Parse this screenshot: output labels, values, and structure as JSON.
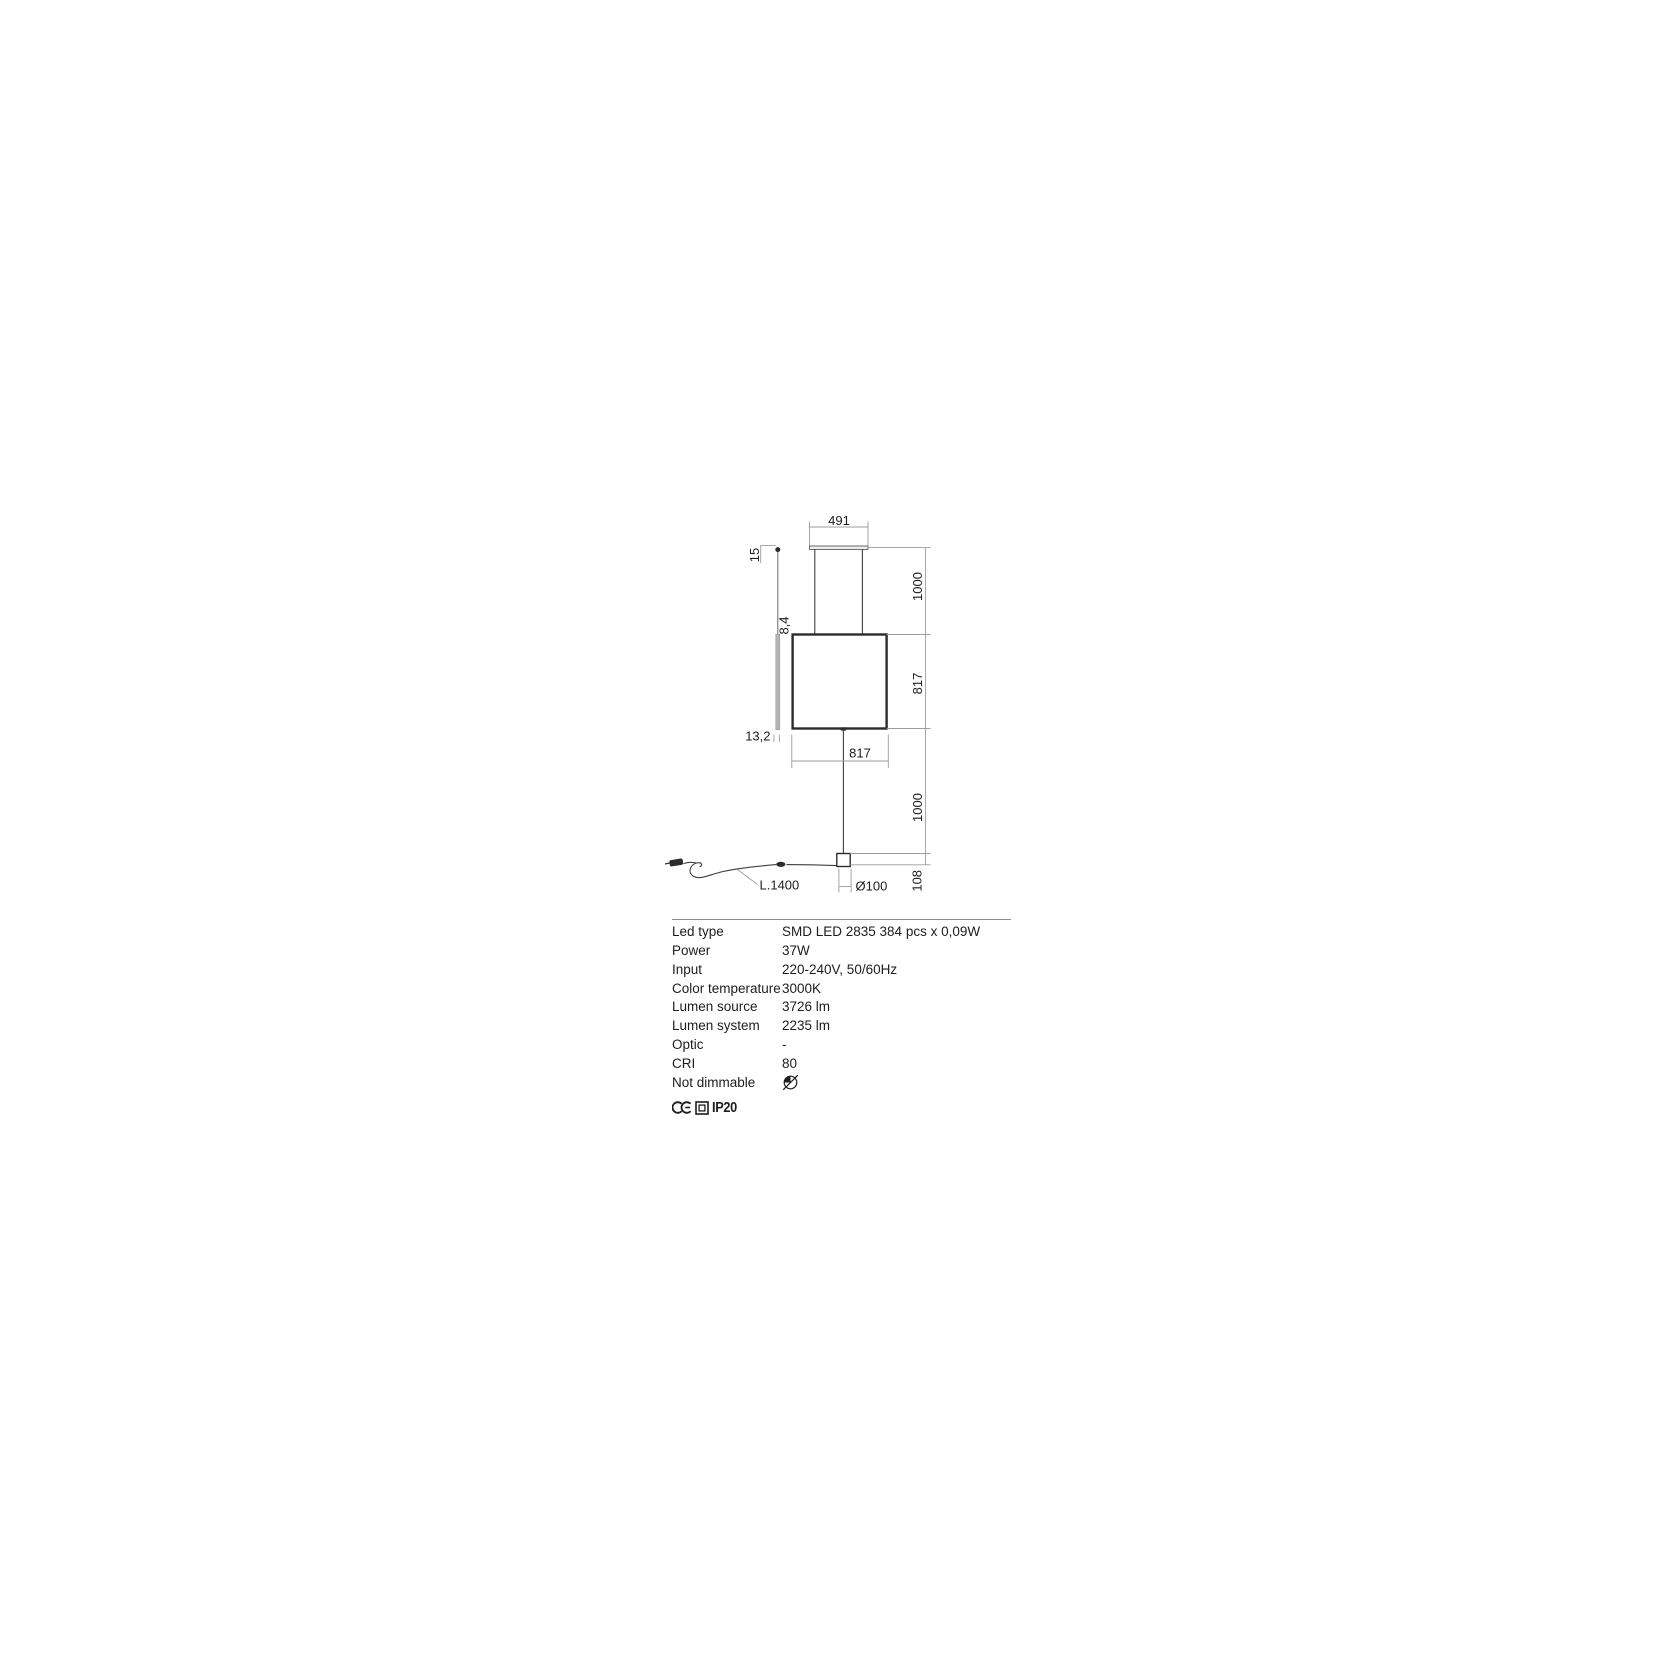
{
  "colors": {
    "ink": "#1d1d1b",
    "line_dark": "#3f3f3e",
    "line_dim": "#9c9c9b",
    "fill_gray": "#b5b5b4"
  },
  "drawing": {
    "dim_top_width": "491",
    "dim_canopy_height": "15",
    "dim_profile_top": "8,4",
    "dim_profile_bottom": "13,2",
    "dim_suspension_top": "1000",
    "dim_body_height": "817",
    "dim_body_width": "817",
    "dim_suspension_bottom": "1000",
    "dim_base_height": "108",
    "dim_base_diameter": "Ø100",
    "dim_cable_length": "L.1400"
  },
  "specs": {
    "rows": [
      {
        "label": "Led type",
        "value": "SMD LED 2835 384 pcs x 0,09W"
      },
      {
        "label": "Power",
        "value": "37W"
      },
      {
        "label": "Input",
        "value": "220-240V, 50/60Hz"
      },
      {
        "label": "Color temperature",
        "value": "3000K"
      },
      {
        "label": "Lumen source",
        "value": "3726 lm"
      },
      {
        "label": "Lumen system",
        "value": "2235 lm"
      },
      {
        "label": "Optic",
        "value": "-"
      },
      {
        "label": "CRI",
        "value": "80"
      },
      {
        "label": "Not dimmable",
        "value": "",
        "icon": "not-dimmable-icon"
      }
    ],
    "marks": {
      "ce_icon": "ce-mark-icon",
      "class2_icon": "double-insulation-icon",
      "ip_rating": "IP20"
    }
  }
}
